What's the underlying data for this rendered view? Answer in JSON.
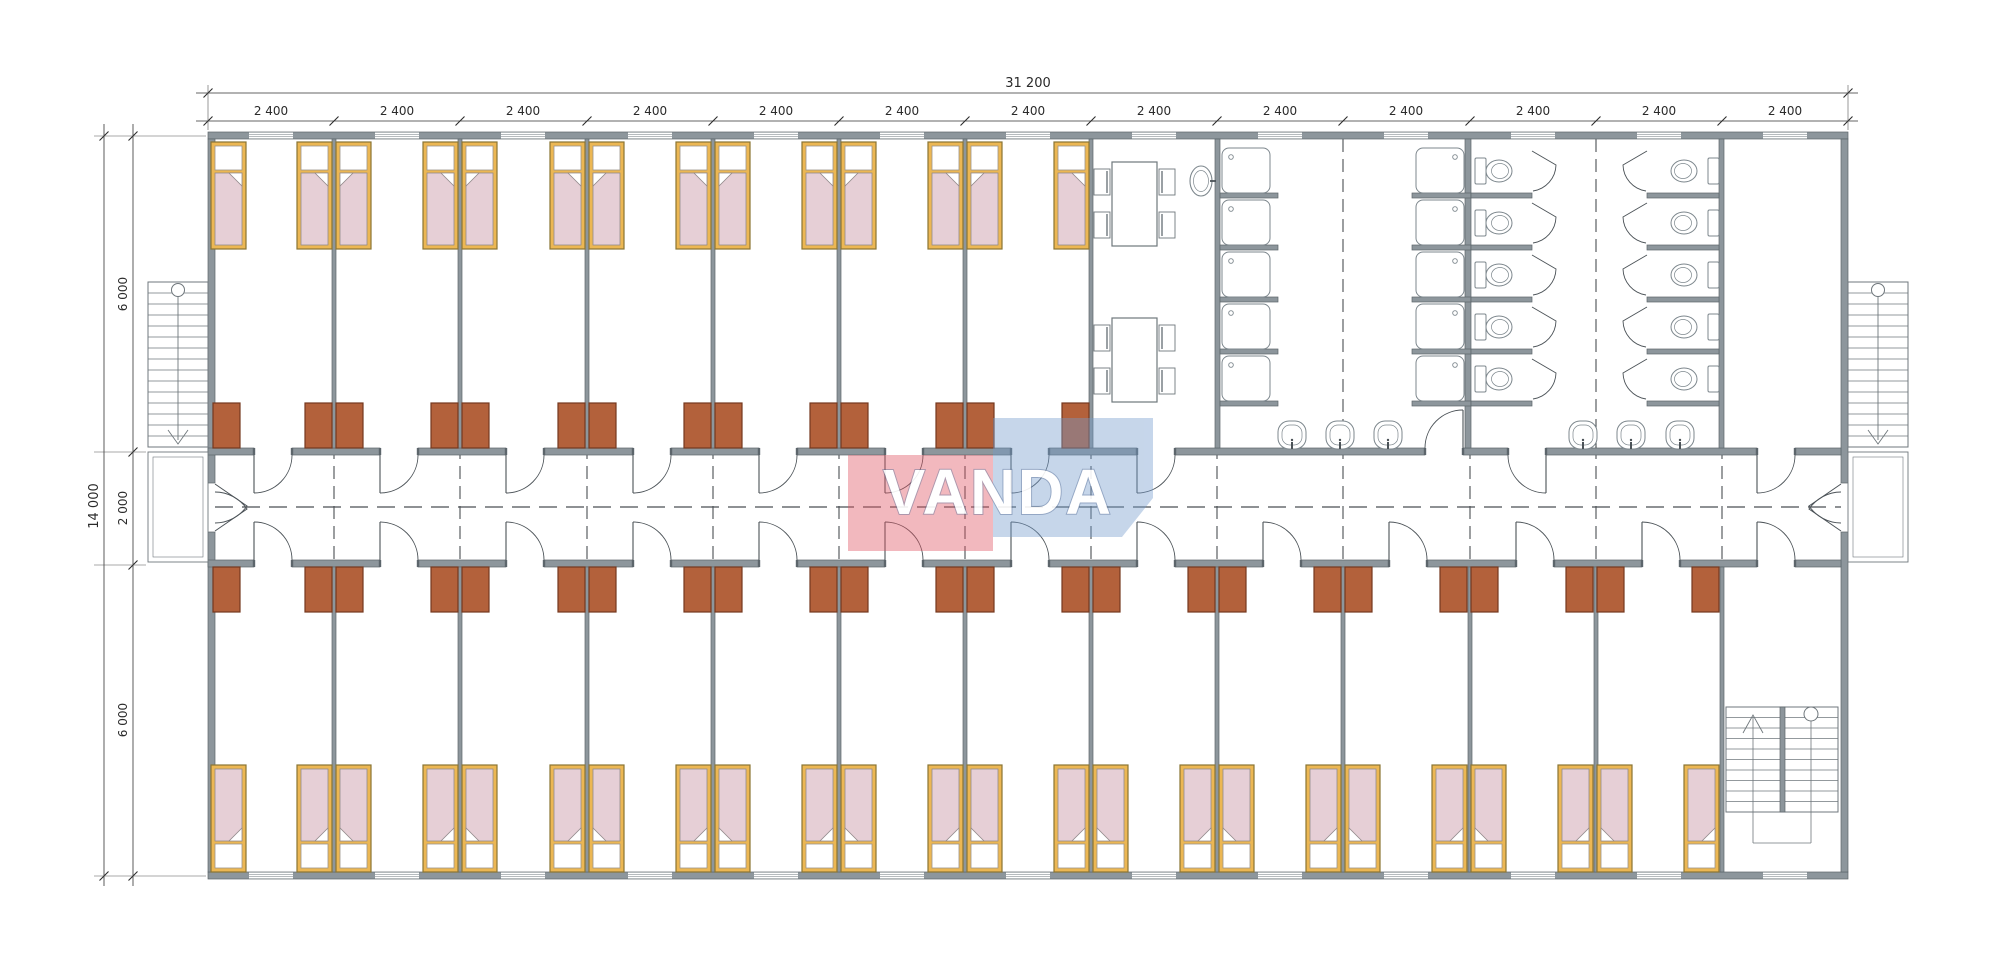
{
  "canvas": {
    "w": 2000,
    "h": 977,
    "bg": "#ffffff"
  },
  "annotations": {
    "overall_width": "31 200",
    "bay_width": "2 400",
    "bay_count": 13,
    "overall_depth": "14 000",
    "room_depth": "6 000",
    "corridor_width": "2 000"
  },
  "logo": {
    "text": "VANDA"
  },
  "colors": {
    "wall_fill": "#8d969c",
    "wall_stroke": "#5c656b",
    "line": "#6f777c",
    "thin": "#8a9298",
    "bed_frame": "#ecb753",
    "bed_frame_stroke": "#8a7433",
    "blanket": "#e6cfd6",
    "blanket_stroke": "#938a8b",
    "pillow": "#ffffff",
    "wardrobe": "#b3613b",
    "wardrobe_stroke": "#74381f",
    "fixture": "#7d878d",
    "door": "#4b5257",
    "dash": "#4a4f53",
    "dim": "#2a2a2a"
  },
  "dim": {
    "top_total": {
      "text": "31 200",
      "y": 93,
      "x1": 196,
      "x2": 1858,
      "ticks": [
        208,
        1848
      ],
      "label_x": 1028,
      "label_y": 87,
      "fs": 13
    },
    "top_bays": {
      "text": "2 400",
      "y": 121,
      "x1": 196,
      "x2": 1858,
      "ticks": [
        208,
        334,
        460,
        587,
        713,
        839,
        965,
        1091,
        1217,
        1343,
        1470,
        1596,
        1722,
        1848
      ],
      "centers": [
        271,
        397,
        523,
        650,
        776,
        902,
        1028,
        1154,
        1280,
        1406,
        1533,
        1659,
        1785
      ],
      "label_y": 115,
      "fs": 12
    },
    "left_total": {
      "text": "14 000",
      "x": 104,
      "y1": 124,
      "y2": 886,
      "ticks": [
        136,
        876
      ],
      "label_x": 98,
      "label_y": 506,
      "fs": 13
    },
    "left_segs": {
      "x": 133,
      "y1": 124,
      "y2": 886,
      "ticks": [
        136,
        452,
        565,
        876
      ],
      "labels": [
        {
          "text": "6 000",
          "y": 294
        },
        {
          "text": "2 000",
          "y": 508
        },
        {
          "text": "6 000",
          "y": 720
        }
      ],
      "label_x": 127,
      "fs": 12
    },
    "ext_h": [
      [
        206,
        94,
        136
      ],
      [
        146,
        94,
        452
      ],
      [
        146,
        94,
        565
      ],
      [
        206,
        94,
        876
      ]
    ],
    "ext_v": [
      [
        208,
        85,
        130
      ],
      [
        1848,
        85,
        130
      ]
    ]
  },
  "scene": {
    "walls": [
      [
        208,
        132,
        1640,
        7
      ],
      [
        208,
        872,
        1640,
        7
      ],
      [
        208,
        139,
        7,
        344
      ],
      [
        208,
        532,
        7,
        340
      ],
      [
        1841,
        139,
        7,
        344
      ],
      [
        1841,
        532,
        7,
        340
      ],
      [
        208,
        448,
        46,
        7
      ],
      [
        292,
        448,
        88,
        7
      ],
      [
        418,
        448,
        88,
        7
      ],
      [
        544,
        448,
        89,
        7
      ],
      [
        671,
        448,
        88,
        7
      ],
      [
        797,
        448,
        88,
        7
      ],
      [
        923,
        448,
        88,
        7
      ],
      [
        1049,
        448,
        88,
        7
      ],
      [
        1175,
        448,
        250,
        7
      ],
      [
        1463,
        448,
        45,
        7
      ],
      [
        1546,
        448,
        211,
        7
      ],
      [
        1795,
        448,
        46,
        7
      ],
      [
        208,
        560,
        46,
        7
      ],
      [
        292,
        560,
        88,
        7
      ],
      [
        418,
        560,
        88,
        7
      ],
      [
        544,
        560,
        89,
        7
      ],
      [
        671,
        560,
        88,
        7
      ],
      [
        797,
        560,
        88,
        7
      ],
      [
        923,
        560,
        88,
        7
      ],
      [
        1049,
        560,
        88,
        7
      ],
      [
        1175,
        560,
        88,
        7
      ],
      [
        1301,
        560,
        88,
        7
      ],
      [
        1427,
        560,
        89,
        7
      ],
      [
        1554,
        560,
        88,
        7
      ],
      [
        1680,
        560,
        77,
        7
      ],
      [
        1795,
        560,
        46,
        7
      ],
      [
        332,
        139,
        4,
        309
      ],
      [
        458,
        139,
        4,
        309
      ],
      [
        585,
        139,
        4,
        309
      ],
      [
        711,
        139,
        4,
        309
      ],
      [
        837,
        139,
        4,
        309
      ],
      [
        963,
        139,
        4,
        309
      ],
      [
        1089,
        139,
        4,
        309
      ],
      [
        1215,
        139,
        5,
        309
      ],
      [
        1465,
        139,
        6,
        309
      ],
      [
        1719,
        139,
        5,
        309
      ],
      [
        332,
        567,
        4,
        305
      ],
      [
        458,
        567,
        4,
        305
      ],
      [
        585,
        567,
        4,
        305
      ],
      [
        711,
        567,
        4,
        305
      ],
      [
        837,
        567,
        4,
        305
      ],
      [
        963,
        567,
        4,
        305
      ],
      [
        1089,
        567,
        4,
        305
      ],
      [
        1215,
        567,
        4,
        305
      ],
      [
        1341,
        567,
        4,
        305
      ],
      [
        1468,
        567,
        4,
        305
      ],
      [
        1594,
        567,
        4,
        305
      ],
      [
        1720,
        567,
        4,
        305
      ],
      [
        1220,
        193,
        58,
        5
      ],
      [
        1220,
        245,
        58,
        5
      ],
      [
        1220,
        297,
        58,
        5
      ],
      [
        1220,
        349,
        58,
        5
      ],
      [
        1220,
        401,
        58,
        5
      ],
      [
        1412,
        193,
        59,
        5
      ],
      [
        1412,
        245,
        59,
        5
      ],
      [
        1412,
        297,
        59,
        5
      ],
      [
        1412,
        349,
        59,
        5
      ],
      [
        1412,
        401,
        59,
        5
      ],
      [
        1471,
        193,
        61,
        5
      ],
      [
        1471,
        245,
        61,
        5
      ],
      [
        1471,
        297,
        61,
        5
      ],
      [
        1471,
        349,
        61,
        5
      ],
      [
        1471,
        401,
        61,
        5
      ],
      [
        1647,
        193,
        72,
        5
      ],
      [
        1647,
        245,
        72,
        5
      ],
      [
        1647,
        297,
        72,
        5
      ],
      [
        1647,
        349,
        72,
        5
      ],
      [
        1647,
        401,
        72,
        5
      ]
    ],
    "windows": {
      "xs": [
        249,
        375,
        501,
        628,
        754,
        880,
        1006,
        1132,
        1258,
        1384,
        1511,
        1637,
        1763
      ],
      "rows": [
        132,
        872
      ],
      "w": 44,
      "h": 7
    },
    "beds": {
      "w": 35,
      "h": 107,
      "top_y": 142,
      "bottom_y": 765,
      "top": [
        [
          211,
          "R"
        ],
        [
          297,
          "R"
        ],
        [
          336,
          "L"
        ],
        [
          423,
          "R"
        ],
        [
          462,
          "L"
        ],
        [
          550,
          "R"
        ],
        [
          589,
          "L"
        ],
        [
          676,
          "R"
        ],
        [
          715,
          "L"
        ],
        [
          802,
          "R"
        ],
        [
          841,
          "L"
        ],
        [
          928,
          "R"
        ],
        [
          967,
          "L"
        ],
        [
          1054,
          "R"
        ]
      ],
      "bottom": [
        [
          211,
          "R"
        ],
        [
          297,
          "R"
        ],
        [
          336,
          "L"
        ],
        [
          423,
          "R"
        ],
        [
          462,
          "L"
        ],
        [
          550,
          "R"
        ],
        [
          589,
          "L"
        ],
        [
          676,
          "R"
        ],
        [
          715,
          "L"
        ],
        [
          802,
          "R"
        ],
        [
          841,
          "L"
        ],
        [
          928,
          "R"
        ],
        [
          967,
          "L"
        ],
        [
          1054,
          "R"
        ],
        [
          1093,
          "L"
        ],
        [
          1180,
          "R"
        ],
        [
          1219,
          "L"
        ],
        [
          1306,
          "R"
        ],
        [
          1345,
          "L"
        ],
        [
          1432,
          "R"
        ],
        [
          1471,
          "L"
        ],
        [
          1558,
          "R"
        ],
        [
          1597,
          "L"
        ],
        [
          1684,
          "R"
        ]
      ]
    },
    "wardrobes": {
      "w": 27,
      "h": 45,
      "top_y": 403,
      "bottom_y": 567,
      "top_x": [
        213,
        305,
        336,
        431,
        462,
        558,
        589,
        684,
        715,
        810,
        841,
        936,
        967,
        1062
      ],
      "bottom_x": [
        213,
        305,
        336,
        431,
        462,
        558,
        589,
        684,
        715,
        810,
        841,
        936,
        967,
        1062,
        1093,
        1188,
        1219,
        1314,
        1345,
        1440,
        1471,
        1566,
        1597,
        1692
      ]
    },
    "doors": [
      [
        254,
        455,
        38,
        "S+"
      ],
      [
        380,
        455,
        38,
        "S+"
      ],
      [
        506,
        455,
        38,
        "S+"
      ],
      [
        633,
        455,
        38,
        "S+"
      ],
      [
        759,
        455,
        38,
        "S+"
      ],
      [
        885,
        455,
        38,
        "S+"
      ],
      [
        1011,
        455,
        38,
        "S+"
      ],
      [
        1137,
        455,
        38,
        "S+"
      ],
      [
        1463,
        448,
        38,
        "N-"
      ],
      [
        1546,
        455,
        38,
        "S-"
      ],
      [
        1757,
        455,
        38,
        "S+"
      ],
      [
        254,
        560,
        38,
        "N+"
      ],
      [
        380,
        560,
        38,
        "N+"
      ],
      [
        506,
        560,
        38,
        "N+"
      ],
      [
        633,
        560,
        38,
        "N+"
      ],
      [
        759,
        560,
        38,
        "N+"
      ],
      [
        885,
        560,
        38,
        "N+"
      ],
      [
        1011,
        560,
        38,
        "N+"
      ],
      [
        1137,
        560,
        38,
        "N+"
      ],
      [
        1263,
        560,
        38,
        "N+"
      ],
      [
        1389,
        560,
        38,
        "N+"
      ],
      [
        1516,
        560,
        38,
        "N+"
      ],
      [
        1642,
        560,
        38,
        "N+"
      ],
      [
        1757,
        560,
        38,
        "N+"
      ]
    ],
    "double_doors": [
      "M215 484 L247 506 A39 39 0 0 1 215 523",
      "M215 531 L247 509 A39 39 0 0 0 215 492",
      "M1841 484 L1809 506 A39 39 0 0 0 1841 523",
      "M1841 531 L1809 509 A39 39 0 0 1 1841 492"
    ],
    "showers": {
      "w": 48,
      "h": 45,
      "ys": [
        148,
        200,
        252,
        304,
        356
      ],
      "cols": [
        {
          "x": 1222,
          "drain": "tl"
        },
        {
          "x": 1416,
          "drain": "tr"
        }
      ]
    },
    "toilets": {
      "cys": [
        171,
        223,
        275,
        327,
        379
      ],
      "cols": [
        {
          "tank_x": 1475,
          "bowl_cx": 1499,
          "dir": 1
        },
        {
          "tank_x": 1708,
          "bowl_cx": 1684,
          "dir": -1
        }
      ]
    },
    "stall_doors": {
      "ys": [
        148,
        200,
        252,
        304,
        356
      ],
      "cols": [
        {
          "x": 1532,
          "dir": 1
        },
        {
          "x": 1647,
          "dir": -1
        }
      ]
    },
    "basins": {
      "y": 421,
      "w": 28,
      "h": 28,
      "cx": [
        1292,
        1340,
        1388,
        1583,
        1631,
        1680
      ]
    },
    "oval_sink": {
      "cx": 1201,
      "cy": 181,
      "rx": 11,
      "ry": 15
    },
    "tables": {
      "w": 45,
      "h": 84,
      "pos": [
        [
          1112,
          162
        ],
        [
          1112,
          318
        ]
      ],
      "chair_w": 16,
      "chair_h": 26,
      "chair_dy": [
        7,
        50
      ]
    },
    "stairs_ext": [
      {
        "x": 148,
        "y": 282,
        "w": 60,
        "run": 165,
        "landing_y": 452,
        "landing_h": 110
      },
      {
        "x": 1848,
        "y": 282,
        "w": 60,
        "run": 165,
        "landing_y": 452,
        "landing_h": 110
      }
    ],
    "stair_int": {
      "x": 1726,
      "y": 707,
      "w": 112,
      "h": 105,
      "div_x": 1780
    },
    "dashes": {
      "center": [
        215,
        507,
        1841,
        507
      ],
      "bay_xs": [
        334,
        460,
        587,
        713,
        839,
        965,
        1091,
        1217,
        1343,
        1470,
        1596,
        1722
      ],
      "bay_y": [
        446,
        569
      ],
      "tall": [
        {
          "x": 1343,
          "y1": 139,
          "y2": 448
        },
        {
          "x": 1596,
          "y1": 139,
          "y2": 448
        }
      ]
    }
  }
}
